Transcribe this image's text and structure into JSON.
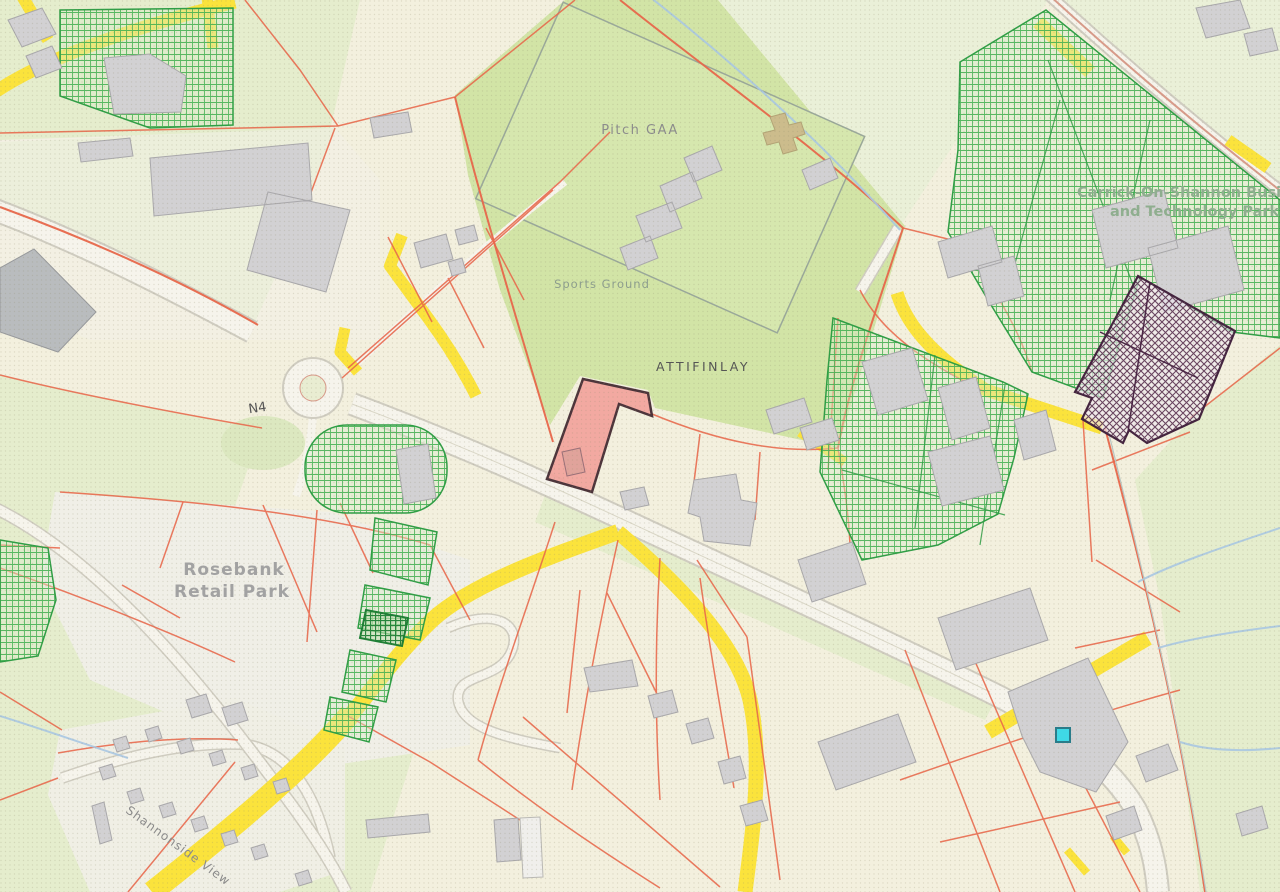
{
  "map": {
    "place_labels": {
      "pitch": "Pitch GAA",
      "sports_ground": "Sports Ground",
      "townland": "ATTIFINLAY",
      "road": "N4",
      "retail_park": {
        "line1": "Rosebank",
        "line2": "Retail Park"
      },
      "business_park": {
        "line1": "Carrick-On-Shannon Busi",
        "line2": "and Technology Park"
      },
      "residential_estate": "Shannonside View"
    },
    "colors": {
      "background_cream": "#f3f0de",
      "field_green": "#e5edcd",
      "sports_green": "#d2e4a6",
      "light_field_green": "#eaf0d8",
      "parcel_line_red": "#e8664a",
      "road_yellow": "#fbe33c",
      "road_white": "#f6f4ec",
      "road_casing": "#cfccc0",
      "building_gray": "#d2d1d3",
      "building_outline": "#a9a8ab",
      "hatch_green_line": "#3fae4e",
      "hatch_purple_line": "#5a3150",
      "selected_parcel_pink": "#f2a39c",
      "selected_parcel_outline": "#3f262e",
      "marker_cyan": "#3fd9e6",
      "marker_border": "#2a7c8a",
      "water_blue": "#a9c6e2",
      "label_gray": "#8c8c8c",
      "label_green": "#8fae8f"
    }
  }
}
